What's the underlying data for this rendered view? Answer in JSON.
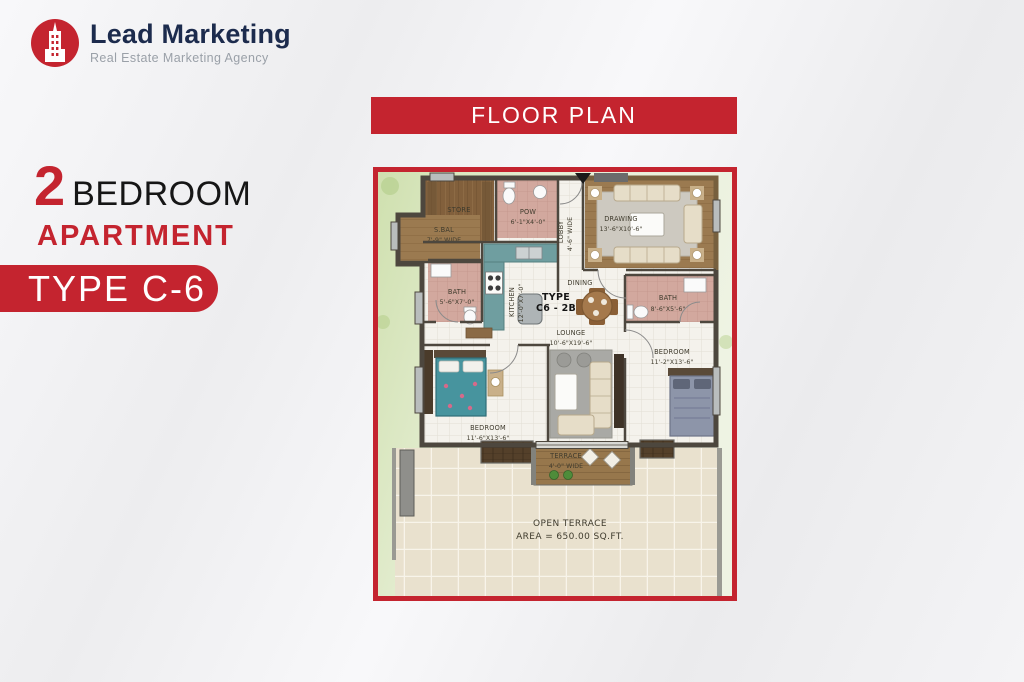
{
  "brand": {
    "name": "Lead Marketing",
    "tagline": "Real Estate Marketing Agency"
  },
  "headline": {
    "number": "2",
    "word1": "BEDROOM",
    "word2": "APARTMENT",
    "badge": "TYPE C-6"
  },
  "banner": {
    "title": "FLOOR PLAN"
  },
  "plan": {
    "unit_type_line1": "TYPE",
    "unit_type_line2": "C6 - 2B",
    "rooms": {
      "store": {
        "name": "STORE",
        "dims": "6'X4'"
      },
      "pow": {
        "name": "POW",
        "dims": "6'-1\"X4'-0\""
      },
      "side_balcony": {
        "name": "S.BAL",
        "dims": "7'-9\" WIDE"
      },
      "lobby": {
        "name": "LOBBY",
        "dims": "4'-6\" WIDE"
      },
      "drawing": {
        "name": "DRAWING",
        "dims": "13'-6\"X10'-6\""
      },
      "dining": {
        "name": "DINING"
      },
      "kitchen": {
        "name": "KITCHEN",
        "dims": "12'-0\"X7'-0\""
      },
      "bath_1": {
        "name": "BATH",
        "dims": "5'-6\"X7'-0\""
      },
      "bath_2": {
        "name": "BATH",
        "dims": "8'-6\"X5'-6\""
      },
      "lounge": {
        "name": "LOUNGE",
        "dims": "10'-6\"X19'-6\""
      },
      "bedroom_1": {
        "name": "BEDROOM",
        "dims": "11'-6\"X13'-6\""
      },
      "bedroom_2": {
        "name": "BEDROOM",
        "dims": "11'-2\"X13'-6\""
      },
      "terrace": {
        "name": "TERRACE",
        "dims": "4'-0\" WIDE"
      },
      "open_terrace": {
        "name": "OPEN TERRACE",
        "dims": "AREA = 650.00 SQ.FT."
      }
    }
  },
  "colors": {
    "accent_red": "#c4242f",
    "navy": "#1c2b4d"
  }
}
